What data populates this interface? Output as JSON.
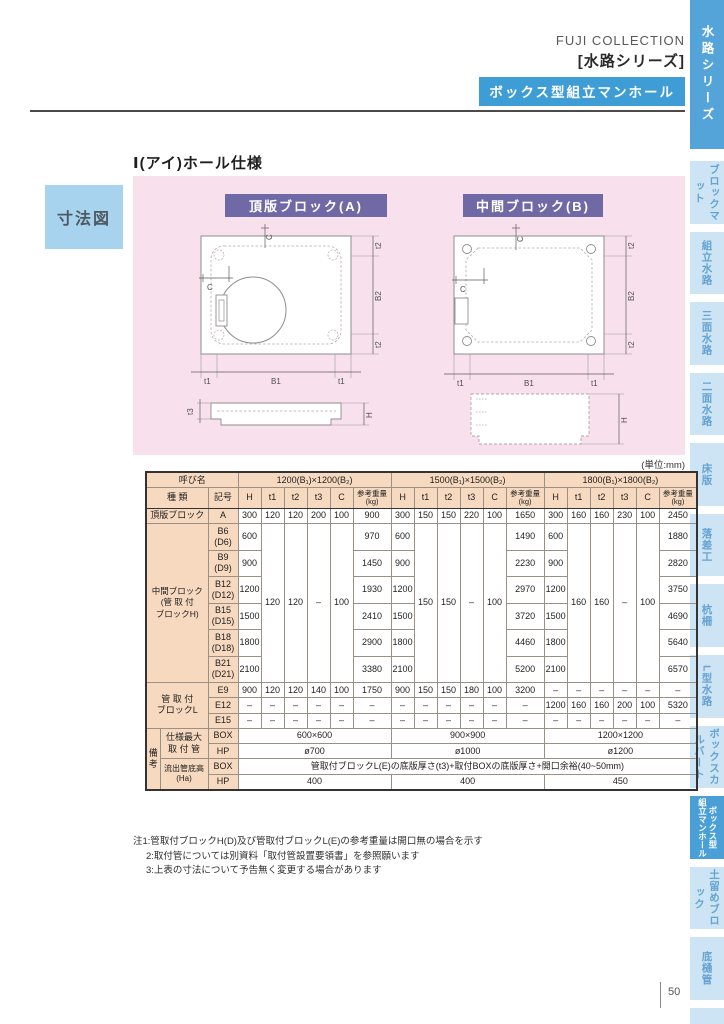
{
  "header": {
    "brand": "FUJI COLLECTION",
    "series": "[水路シリーズ]",
    "badge": "ボックス型組立マンホール"
  },
  "sidebar": {
    "top_tab": "水路シリーズ",
    "tabs": [
      {
        "label": "ブロックマット"
      },
      {
        "label": "組立水路"
      },
      {
        "label": "三面水路"
      },
      {
        "label": "二面水路"
      },
      {
        "label": "床版"
      },
      {
        "label": "落差工"
      },
      {
        "label": "杭柵"
      },
      {
        "label": "L型水路"
      },
      {
        "label": "ボックスカルバート"
      },
      {
        "label": "ボックス型組立マンホール",
        "active": true,
        "split": [
          "組立マンホール",
          "ボックス型"
        ]
      },
      {
        "label": "土留めブロック"
      },
      {
        "label": "底樋管"
      }
    ]
  },
  "section": {
    "side_label": "寸法図",
    "title": "Ⅰ(アイ)ホール仕様",
    "badge_a": "頂版ブロック(A)",
    "badge_b": "中間ブロック(B)"
  },
  "dims": {
    "t1": "t1",
    "t2": "t2",
    "t3": "t3",
    "b1": "B1",
    "b2": "B2",
    "c": "C",
    "h": "H"
  },
  "table": {
    "unit": "(単位:mm)",
    "yobina": "呼び名",
    "shurui": "種  類",
    "kigo": "記号",
    "groups": [
      "1200(B₁)×1200(B₂)",
      "1500(B₁)×1500(B₂)",
      "1800(B₁)×1800(B₂)"
    ],
    "sub": {
      "h": "H",
      "t1": "t1",
      "t2": "t2",
      "t3": "t3",
      "c": "C",
      "w1": "参考重量",
      "w2": "(kg)"
    },
    "top_row": {
      "type": "頂版ブロック",
      "code": "A",
      "cells": [
        "300",
        "120",
        "120",
        "200",
        "100",
        "900",
        "300",
        "150",
        "150",
        "220",
        "100",
        "1650",
        "300",
        "160",
        "160",
        "230",
        "100",
        "2450"
      ]
    },
    "middle": {
      "label": "中間ブロック",
      "sublabel": "(管 取 付\nブロックH)",
      "merged": {
        "g1": [
          "120",
          "120",
          "–",
          "100"
        ],
        "g2": [
          "150",
          "150",
          "–",
          "100"
        ],
        "g3": [
          "160",
          "160",
          "–",
          "100"
        ]
      },
      "rows": [
        {
          "code": "B6\n(D6)",
          "h": "600",
          "w": [
            "970",
            "1490",
            "1880"
          ]
        },
        {
          "code": "B9\n(D9)",
          "h": "900",
          "w": [
            "1450",
            "2230",
            "2820"
          ]
        },
        {
          "code": "B12\n(D12)",
          "h": "1200",
          "w": [
            "1930",
            "2970",
            "3750"
          ]
        },
        {
          "code": "B15\n(D15)",
          "h": "1500",
          "w": [
            "2410",
            "3720",
            "4690"
          ]
        },
        {
          "code": "B18\n(D18)",
          "h": "1800",
          "w": [
            "2900",
            "4460",
            "5640"
          ]
        },
        {
          "code": "B21\n(D21)",
          "h": "2100",
          "w": [
            "3380",
            "5200",
            "6570"
          ]
        }
      ]
    },
    "lblock": {
      "label": "管 取 付\nブロックL",
      "rows": [
        {
          "code": "E9",
          "cells": [
            "900",
            "120",
            "120",
            "140",
            "100",
            "1750",
            "900",
            "150",
            "150",
            "180",
            "100",
            "3200",
            "–",
            "–",
            "–",
            "–",
            "–",
            "–"
          ]
        },
        {
          "code": "E12",
          "cells": [
            "–",
            "–",
            "–",
            "–",
            "–",
            "–",
            "–",
            "–",
            "–",
            "–",
            "–",
            "–",
            "1200",
            "160",
            "160",
            "200",
            "100",
            "5320"
          ]
        },
        {
          "code": "E15",
          "cells": [
            "–",
            "–",
            "–",
            "–",
            "–",
            "–",
            "–",
            "–",
            "–",
            "–",
            "–",
            "–",
            "–",
            "–",
            "–",
            "–",
            "–",
            "–"
          ]
        }
      ]
    },
    "remarks": {
      "biko": "備\n考",
      "max_label": "仕様最大\n取 付 管",
      "flow_label": "流出管底高\n(Ha)",
      "box": "BOX",
      "hp": "HP",
      "max_box": [
        "600×600",
        "900×900",
        "1200×1200"
      ],
      "max_hp": [
        "ø700",
        "ø1000",
        "ø1200"
      ],
      "flow_box": "管取付ブロックL(E)の底版厚さ(t3)+取付BOXの底版厚さ+開口余裕(40~50mm)",
      "flow_hp": [
        "400",
        "400",
        "450"
      ]
    }
  },
  "notes": [
    "注1:管取付ブロックH(D)及び管取付ブロックL(E)の参考重量は開口無の場合を示す",
    "2:取付管については別資料「取付管設置要領書」を参照願います",
    "3:上表の寸法について予告無く変更する場合があります"
  ],
  "page_number": "50",
  "colors": {
    "accent_blue": "#3f9dd5",
    "sidebar_blue": "#54a4d9",
    "tab_light": "#cde4f5",
    "tab_text": "#66a3d2",
    "panel_pink": "#f8e1ec",
    "badge_purple": "#6f6aa6",
    "table_tan": "#f6d9bf",
    "dim_box_blue": "#a7d3ee"
  }
}
